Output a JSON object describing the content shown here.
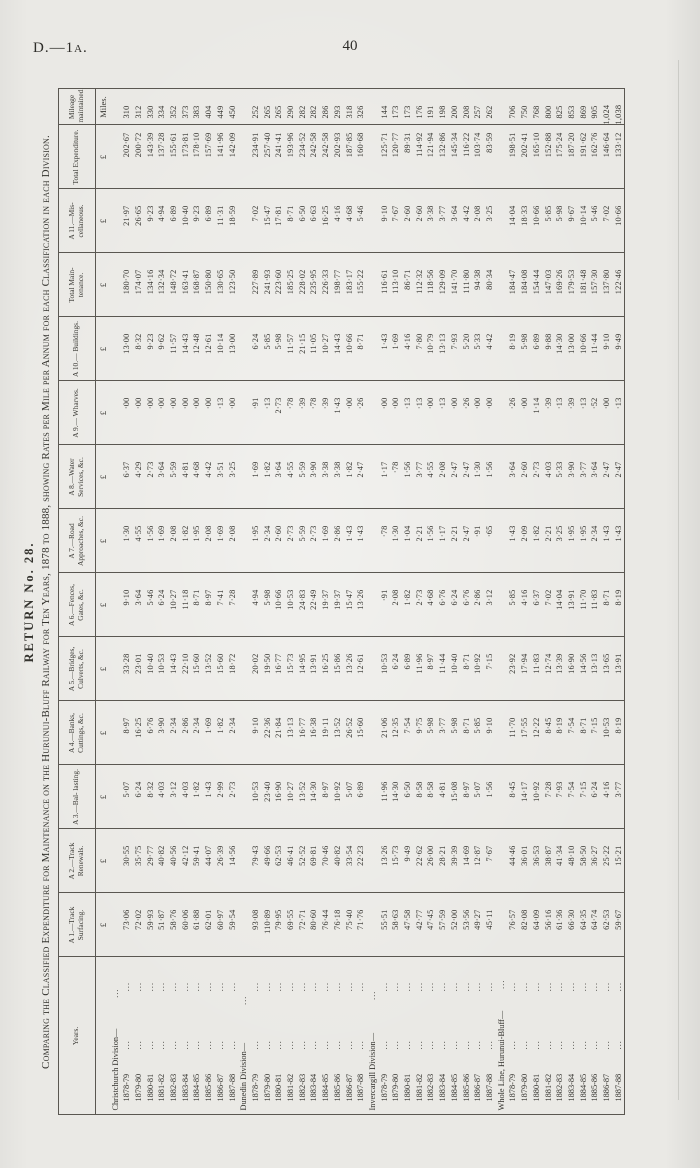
{
  "page": {
    "doc_ref": "D.—1a.",
    "page_number": "40"
  },
  "table": {
    "title": "RETURN No. 28.",
    "subtitle": "Comparing the Classified Expenditure for Maintenance on the Hurunui-Bluff Railway for Ten Years, 1878 to 1888, showing Rates per Mile per Annum for each Classification in each Division.",
    "leader_dots": "...",
    "columns": [
      {
        "label": "Years.",
        "unit": ""
      },
      {
        "label": "A 1.—Track Surfacing.",
        "unit": "£"
      },
      {
        "label": "A 2.—Track Renewals.",
        "unit": "£"
      },
      {
        "label": "A 3.—Bal- lasting.",
        "unit": "£"
      },
      {
        "label": "A 4.—Banks, Cuttings, &c.",
        "unit": "£"
      },
      {
        "label": "A 5.—Bridges, Culverts, &c.",
        "unit": "£"
      },
      {
        "label": "A 6.—Fences, Gates, &c.",
        "unit": "£"
      },
      {
        "label": "A 7.—Road Approaches, &c.",
        "unit": "£"
      },
      {
        "label": "A 8.—Water Services, &c.",
        "unit": "£"
      },
      {
        "label": "A 9.— Wharves.",
        "unit": "£"
      },
      {
        "label": "A 10.— Buildings.",
        "unit": "£"
      },
      {
        "label": "Total Main- tenance.",
        "unit": "£"
      },
      {
        "label": "A 11.—Mis- cellaneous.",
        "unit": "£"
      },
      {
        "label": "Total Expenditure.",
        "unit": "£"
      },
      {
        "label": "Mileage maintained.",
        "unit": "Miles."
      }
    ],
    "groups": [
      {
        "heading": "Christchurch Division—",
        "rows": [
          {
            "year": "1878-79",
            "values": [
              "73·06",
              "30·55",
              "5·07",
              "8·97",
              "33·28",
              "9·10",
              "1·30",
              "6·37",
              "·00",
              "13·00",
              "180·70",
              "21·97",
              "202·67",
              "310"
            ]
          },
          {
            "year": "1879-80",
            "values": [
              "72·02",
              "35·75",
              "6·24",
              "16·25",
              "23·01",
              "3·64",
              "4·55",
              "4·29",
              "·00",
              "8·32",
              "174·07",
              "26·65",
              "200·72",
              "312"
            ]
          },
          {
            "year": "1880-81",
            "values": [
              "59·93",
              "29·77",
              "8·32",
              "6·76",
              "10·40",
              "5·46",
              "1·56",
              "2·73",
              "·00",
              "9·23",
              "134·16",
              "9·23",
              "143·39",
              "330"
            ]
          },
          {
            "year": "1881-82",
            "values": [
              "51·87",
              "40·82",
              "4·03",
              "3·90",
              "10·53",
              "6·24",
              "1·69",
              "3·64",
              "·00",
              "9·62",
              "132·34",
              "4·94",
              "137·28",
              "334"
            ]
          },
          {
            "year": "1882-83",
            "values": [
              "58·76",
              "40·56",
              "3·12",
              "2·34",
              "14·43",
              "10·27",
              "2·08",
              "5·59",
              "·00",
              "11·57",
              "148·72",
              "6·89",
              "155·61",
              "352"
            ]
          },
          {
            "year": "1883-84",
            "values": [
              "60·06",
              "42·12",
              "4·03",
              "2·86",
              "22·10",
              "11·18",
              "1·82",
              "4·81",
              "·00",
              "14·43",
              "163·41",
              "10·40",
              "173·81",
              "373"
            ]
          },
          {
            "year": "1884-85",
            "values": [
              "61·88",
              "59·41",
              "1·82",
              "2·34",
              "15·60",
              "8·71",
              "1·95",
              "4·68",
              "·00",
              "12·48",
              "168·87",
              "9·23",
              "178·10",
              "383"
            ]
          },
          {
            "year": "1885-86",
            "values": [
              "62·01",
              "44·07",
              "1·43",
              "1·69",
              "13·52",
              "8·97",
              "2·08",
              "4·42",
              "·00",
              "12·61",
              "150·80",
              "6·89",
              "157·69",
              "404"
            ]
          },
          {
            "year": "1886-87",
            "values": [
              "60·97",
              "26·39",
              "2·99",
              "1·82",
              "15·60",
              "7·41",
              "1·69",
              "3·51",
              "·13",
              "10·14",
              "130·65",
              "11·31",
              "141·96",
              "449"
            ]
          },
          {
            "year": "1887-88",
            "values": [
              "59·54",
              "14·56",
              "2·73",
              "2·34",
              "18·72",
              "7·28",
              "2·08",
              "3·25",
              "·00",
              "13·00",
              "123·50",
              "18·59",
              "142·09",
              "450"
            ]
          }
        ]
      },
      {
        "heading": "Dunedin Division—",
        "rows": [
          {
            "year": "1878-79",
            "values": [
              "93·08",
              "79·43",
              "10·53",
              "9·10",
              "20·02",
              "4·94",
              "1·95",
              "1·69",
              "·91",
              "6·24",
              "227·89",
              "7·02",
              "234·91",
              "252"
            ]
          },
          {
            "year": "1879-80",
            "values": [
              "110·89",
              "49·66",
              "23·40",
              "22·36",
              "19·50",
              "5·98",
              "2·34",
              "1·82",
              "·13",
              "5·85",
              "241·93",
              "15·47",
              "257·40",
              "265"
            ]
          },
          {
            "year": "1880-81",
            "values": [
              "79·95",
              "62·53",
              "16·90",
              "21·84",
              "16·77",
              "10·66",
              "2·60",
              "3·64",
              "2·73",
              "5·98",
              "223·60",
              "17·81",
              "241·41",
              "265"
            ]
          },
          {
            "year": "1881-82",
            "values": [
              "69·55",
              "46·41",
              "10·27",
              "13·13",
              "15·73",
              "10·53",
              "2·73",
              "4·55",
              "·78",
              "11·57",
              "185·25",
              "8·71",
              "193·96",
              "290"
            ]
          },
          {
            "year": "1882-83",
            "values": [
              "72·71",
              "52·52",
              "13·52",
              "16·77",
              "14·95",
              "24·83",
              "5·59",
              "5·59",
              "·39",
              "21·15",
              "228·02",
              "6·50",
              "234·52",
              "282"
            ]
          },
          {
            "year": "1883-84",
            "values": [
              "80·60",
              "69·81",
              "14·30",
              "16·38",
              "13·91",
              "22·49",
              "2·73",
              "3·90",
              "·78",
              "11·05",
              "235·95",
              "6·63",
              "242·58",
              "282"
            ]
          },
          {
            "year": "1884-85",
            "values": [
              "76·44",
              "70·46",
              "8·97",
              "19·11",
              "16·25",
              "19·37",
              "1·69",
              "3·38",
              "·39",
              "10·27",
              "226·33",
              "16·25",
              "242·58",
              "286"
            ]
          },
          {
            "year": "1885-86",
            "values": [
              "76·18",
              "40·82",
              "10·92",
              "13·52",
              "15·86",
              "19·37",
              "2·86",
              "3·38",
              "1·43",
              "14·43",
              "198·77",
              "4·16",
              "202·93",
              "293"
            ]
          },
          {
            "year": "1886-87",
            "values": [
              "75·40",
              "33·54",
              "5·07",
              "26·52",
              "13·26",
              "15·47",
              "1·43",
              "1·82",
              "·00",
              "10·66",
              "183·17",
              "4·68",
              "187·85",
              "318"
            ]
          },
          {
            "year": "1887-88",
            "values": [
              "71·76",
              "22·23",
              "6·89",
              "15·60",
              "12·61",
              "13·26",
              "1·43",
              "2·47",
              "·26",
              "8·71",
              "155·22",
              "5·46",
              "160·68",
              "326"
            ]
          }
        ]
      },
      {
        "heading": "Invercargill Division—",
        "rows": [
          {
            "year": "1878-79",
            "values": [
              "55·51",
              "13·26",
              "11·96",
              "21·06",
              "10·53",
              "·91",
              "·78",
              "1·17",
              "·00",
              "1·43",
              "116·61",
              "9·10",
              "125·71",
              "144"
            ]
          },
          {
            "year": "1879-80",
            "values": [
              "58·63",
              "15·73",
              "14·30",
              "12·35",
              "6·24",
              "2·08",
              "1·30",
              "·78",
              "·00",
              "1·69",
              "113·10",
              "7·67",
              "120·77",
              "173"
            ]
          },
          {
            "year": "1880-81",
            "values": [
              "47·58",
              "9·49",
              "6·50",
              "7·54",
              "6·89",
              "1·82",
              "1·04",
              "1·56",
              "·13",
              "4·16",
              "86·71",
              "2·60",
              "89·31",
              "173"
            ]
          },
          {
            "year": "1881-82",
            "values": [
              "42·77",
              "22·62",
              "8·58",
              "9·75",
              "11·96",
              "2·73",
              "2·21",
              "3·77",
              "·13",
              "7·80",
              "112·32",
              "2·60",
              "114·92",
              "176"
            ]
          },
          {
            "year": "1882-83",
            "values": [
              "47·45",
              "26·00",
              "8·58",
              "5·98",
              "8·97",
              "4·68",
              "1·56",
              "4·55",
              "·00",
              "10·79",
              "118·56",
              "3·38",
              "121·94",
              "191"
            ]
          },
          {
            "year": "1883-84",
            "values": [
              "57·59",
              "28·21",
              "4·81",
              "3·77",
              "11·44",
              "6·76",
              "1·17",
              "2·08",
              "·13",
              "13·13",
              "129·09",
              "3·77",
              "132·86",
              "198"
            ]
          },
          {
            "year": "1884-85",
            "values": [
              "52·00",
              "39·39",
              "15·08",
              "5·98",
              "10·40",
              "6·24",
              "2·21",
              "2·47",
              "·00",
              "7·93",
              "141·70",
              "3·64",
              "145·34",
              "200"
            ]
          },
          {
            "year": "1885-86",
            "values": [
              "53·56",
              "14·69",
              "8·97",
              "8·71",
              "8·71",
              "6·76",
              "2·47",
              "2·47",
              "·26",
              "5·20",
              "111·80",
              "4·42",
              "116·22",
              "208"
            ]
          },
          {
            "year": "1886-87",
            "values": [
              "49·27",
              "12·87",
              "5·07",
              "5·85",
              "10·92",
              "2·86",
              "·91",
              "1·30",
              "·00",
              "5·33",
              "94·38",
              "2·08",
              "103·74",
              "257"
            ]
          },
          {
            "year": "1887-88",
            "values": [
              "45·11",
              "7·67",
              "1·56",
              "9·10",
              "7·15",
              "3·12",
              "·65",
              "1·56",
              "·00",
              "4·42",
              "80·34",
              "3·25",
              "83·59",
              "262"
            ]
          }
        ]
      },
      {
        "heading": "Whole Line, Hurunui-Bluff—",
        "rows": [
          {
            "year": "1878-79",
            "values": [
              "76·57",
              "44·46",
              "8·45",
              "11·70",
              "23·92",
              "5·85",
              "1·43",
              "3·64",
              "·26",
              "8·19",
              "184·47",
              "14·04",
              "198·51",
              "706"
            ]
          },
          {
            "year": "1879-80",
            "values": [
              "82·08",
              "36·01",
              "14·17",
              "17·55",
              "17·94",
              "4·16",
              "2·09",
              "2·60",
              "·00",
              "5·98",
              "184·08",
              "18·33",
              "202·41",
              "750"
            ]
          },
          {
            "year": "1880-81",
            "values": [
              "64·09",
              "36·53",
              "10·92",
              "12·22",
              "11·83",
              "6·37",
              "1·82",
              "2·73",
              "1·14",
              "6·89",
              "154·44",
              "10·66",
              "165·10",
              "768"
            ]
          },
          {
            "year": "1881-82",
            "values": [
              "56·16",
              "38·87",
              "7·28",
              "8·45",
              "12·74",
              "7·02",
              "2·21",
              "4·03",
              "·39",
              "9·88",
              "147·03",
              "5·85",
              "152·88",
              "800"
            ]
          },
          {
            "year": "1882-83",
            "values": [
              "61·36",
              "41·34",
              "7·93",
              "8·19",
              "13·39",
              "14·04",
              "3·25",
              "5·33",
              "·13",
              "14·30",
              "169·26",
              "5·98",
              "175·24",
              "825"
            ]
          },
          {
            "year": "1883-84",
            "values": [
              "66·30",
              "48·10",
              "7·54",
              "7·54",
              "16·90",
              "13·91",
              "1·95",
              "3·90",
              "·39",
              "13·00",
              "179·53",
              "9·67",
              "187·20",
              "853"
            ]
          },
          {
            "year": "1884-85",
            "values": [
              "64·35",
              "58·50",
              "7·15",
              "8·71",
              "14·56",
              "11·70",
              "1·95",
              "3·77",
              "·13",
              "10·66",
              "181·48",
              "10·14",
              "191·62",
              "869"
            ]
          },
          {
            "year": "1885-86",
            "values": [
              "64·74",
              "36·27",
              "6·24",
              "7·15",
              "13·13",
              "11·83",
              "2·34",
              "3·64",
              "·52",
              "11·44",
              "157·30",
              "5·46",
              "162·76",
              "905"
            ]
          },
          {
            "year": "1886-87",
            "values": [
              "62·53",
              "25·22",
              "4·16",
              "10·53",
              "13·65",
              "8·71",
              "1·43",
              "2·47",
              "·00",
              "9·10",
              "137·80",
              "7·02",
              "146·64",
              "1,024"
            ]
          },
          {
            "year": "1887-88",
            "values": [
              "59·67",
              "15·21",
              "3·77",
              "8·19",
              "13·91",
              "8·19",
              "1·43",
              "2·47",
              "·13",
              "9·49",
              "122·46",
              "10·66",
              "133·12",
              "1,038"
            ]
          }
        ]
      }
    ]
  }
}
